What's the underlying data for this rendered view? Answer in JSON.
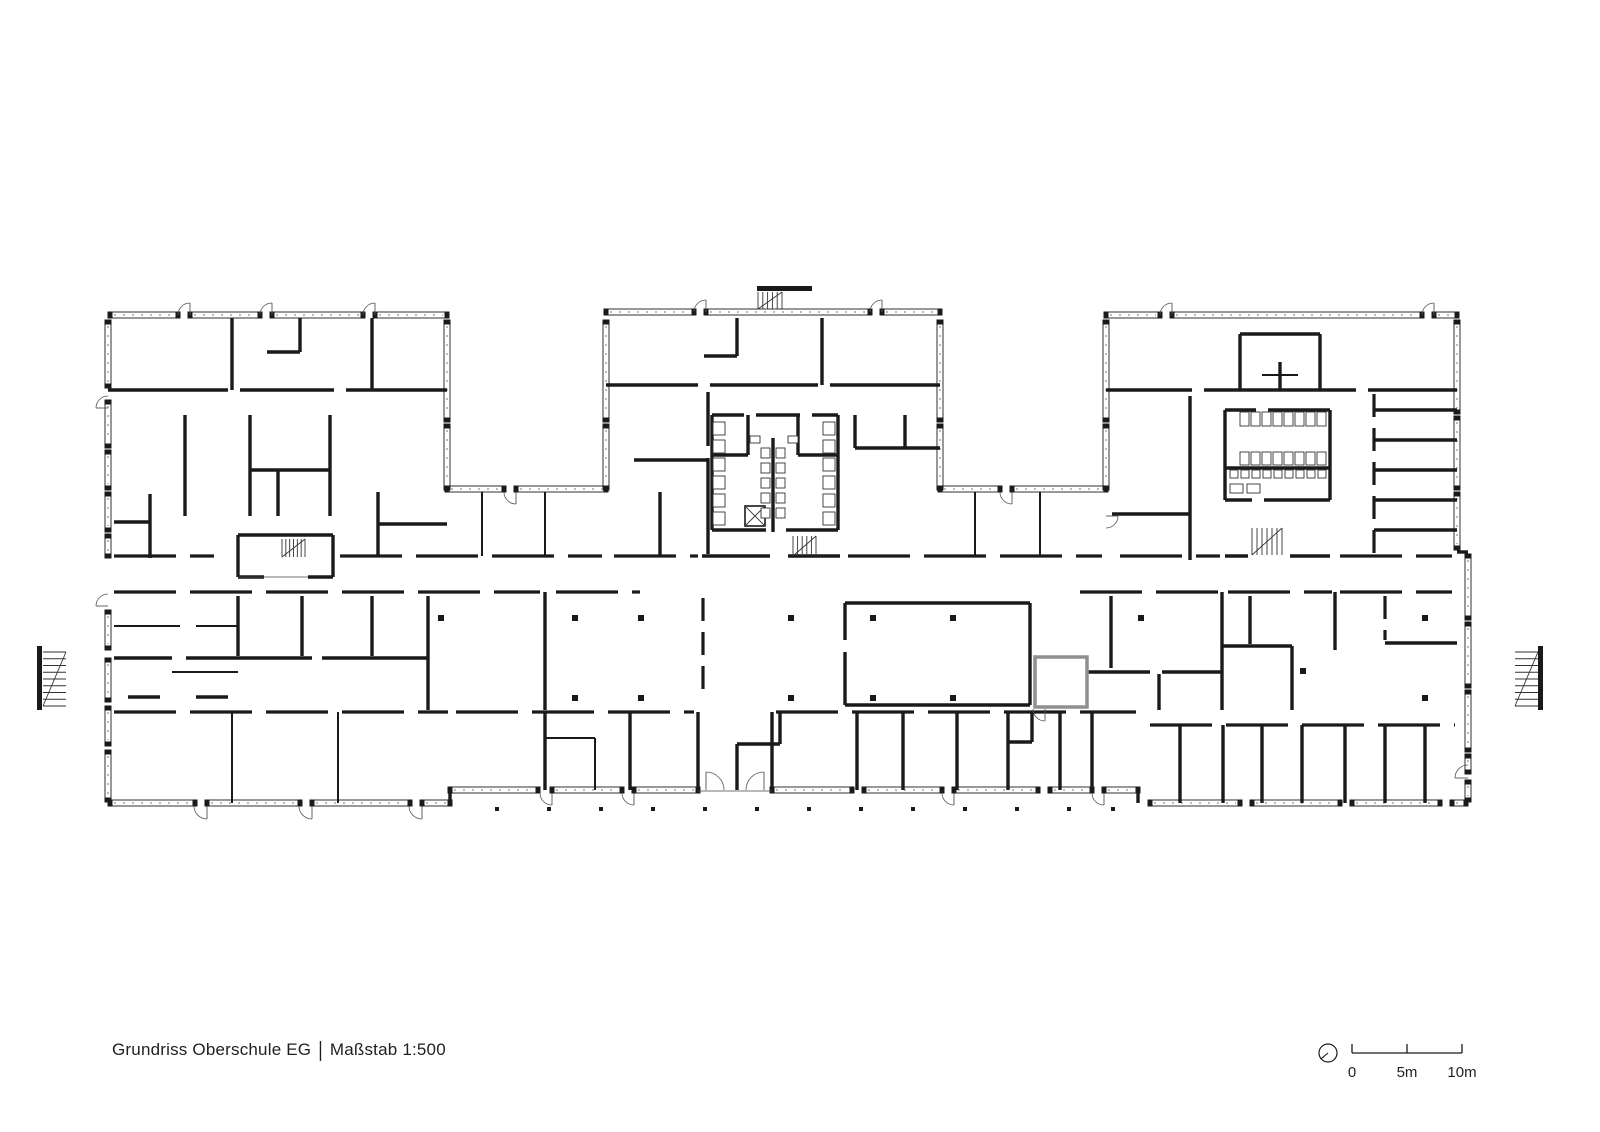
{
  "title_block": {
    "project": "Grundriss Oberschule EG",
    "separator": "|",
    "scale_text": "Maßstab 1:500"
  },
  "scale_bar": {
    "labels": [
      "0",
      "5m",
      "10m"
    ],
    "ticks_x": [
      1352,
      1407,
      1462
    ],
    "bar_y": 1053,
    "tick_h": 9,
    "north_circle": {
      "cx": 1328,
      "cy": 1053,
      "r": 9
    }
  },
  "drawing": {
    "ink": "#1a1a1a",
    "gray": "#8f8f8f",
    "canvas": {
      "w": 1600,
      "h": 1132
    },
    "walls_thick": [
      [
        108,
        390,
        228,
        390
      ],
      [
        240,
        390,
        334,
        390
      ],
      [
        346,
        390,
        447,
        390
      ],
      [
        232,
        318,
        232,
        390
      ],
      [
        372,
        318,
        372,
        390
      ],
      [
        300,
        318,
        300,
        352
      ],
      [
        267,
        352,
        300,
        352
      ],
      [
        185,
        415,
        185,
        516
      ],
      [
        250,
        415,
        250,
        516
      ],
      [
        330,
        415,
        330,
        516
      ],
      [
        278,
        470,
        278,
        516
      ],
      [
        250,
        470,
        330,
        470
      ],
      [
        150,
        494,
        150,
        558
      ],
      [
        114,
        522,
        150,
        522
      ],
      [
        238,
        535,
        333,
        535
      ],
      [
        238,
        535,
        238,
        577
      ],
      [
        333,
        535,
        333,
        577
      ],
      [
        238,
        577,
        264,
        577
      ],
      [
        308,
        577,
        333,
        577
      ],
      [
        378,
        492,
        378,
        556
      ],
      [
        378,
        524,
        447,
        524
      ],
      [
        606,
        385,
        698,
        385
      ],
      [
        710,
        385,
        818,
        385
      ],
      [
        830,
        385,
        940,
        385
      ],
      [
        737,
        318,
        737,
        356
      ],
      [
        704,
        356,
        737,
        356
      ],
      [
        822,
        318,
        822,
        385
      ],
      [
        708,
        392,
        708,
        446
      ],
      [
        708,
        458,
        708,
        554
      ],
      [
        634,
        460,
        708,
        460
      ],
      [
        660,
        492,
        660,
        556
      ],
      [
        712,
        415,
        744,
        415
      ],
      [
        756,
        415,
        800,
        415
      ],
      [
        812,
        415,
        838,
        415
      ],
      [
        712,
        415,
        712,
        530
      ],
      [
        838,
        415,
        838,
        530
      ],
      [
        773,
        438,
        773,
        532
      ],
      [
        712,
        455,
        748,
        455
      ],
      [
        798,
        455,
        838,
        455
      ],
      [
        748,
        415,
        748,
        455
      ],
      [
        798,
        415,
        798,
        455
      ],
      [
        712,
        530,
        766,
        530
      ],
      [
        786,
        530,
        838,
        530
      ],
      [
        702,
        556,
        770,
        556
      ],
      [
        788,
        556,
        840,
        556
      ],
      [
        855,
        415,
        855,
        448
      ],
      [
        855,
        448,
        940,
        448
      ],
      [
        905,
        415,
        905,
        448
      ],
      [
        1106,
        390,
        1192,
        390
      ],
      [
        1204,
        390,
        1356,
        390
      ],
      [
        1368,
        390,
        1457,
        390
      ],
      [
        1240,
        334,
        1240,
        390
      ],
      [
        1320,
        334,
        1320,
        390
      ],
      [
        1240,
        334,
        1320,
        334
      ],
      [
        1280,
        362,
        1280,
        390
      ],
      [
        1225,
        410,
        1256,
        410
      ],
      [
        1268,
        410,
        1330,
        410
      ],
      [
        1225,
        410,
        1225,
        500
      ],
      [
        1330,
        410,
        1330,
        500
      ],
      [
        1225,
        468,
        1330,
        468
      ],
      [
        1225,
        500,
        1252,
        500
      ],
      [
        1264,
        500,
        1330,
        500
      ],
      [
        1190,
        396,
        1190,
        514
      ],
      [
        1112,
        514,
        1190,
        514
      ],
      [
        1190,
        514,
        1190,
        560
      ],
      [
        1225,
        556,
        1248,
        556
      ],
      [
        1290,
        556,
        1330,
        556
      ],
      [
        1374,
        410,
        1457,
        410
      ],
      [
        1374,
        440,
        1457,
        440
      ],
      [
        1374,
        470,
        1457,
        470
      ],
      [
        1374,
        500,
        1457,
        500
      ],
      [
        1374,
        530,
        1457,
        530
      ],
      [
        450,
        790,
        450,
        806
      ],
      [
        1138,
        790,
        1138,
        803
      ],
      [
        238,
        596,
        238,
        656
      ],
      [
        302,
        596,
        302,
        656
      ],
      [
        372,
        596,
        372,
        656
      ],
      [
        428,
        596,
        428,
        710
      ],
      [
        545,
        592,
        545,
        710
      ],
      [
        114,
        658,
        172,
        658
      ],
      [
        186,
        658,
        312,
        658
      ],
      [
        322,
        658,
        428,
        658
      ],
      [
        128,
        697,
        160,
        697
      ],
      [
        196,
        697,
        228,
        697
      ],
      [
        845,
        603,
        1030,
        603
      ],
      [
        1030,
        603,
        1030,
        705
      ],
      [
        845,
        705,
        1030,
        705
      ],
      [
        845,
        603,
        845,
        640
      ],
      [
        845,
        652,
        845,
        705
      ],
      [
        1111,
        596,
        1111,
        668
      ],
      [
        1085,
        672,
        1150,
        672
      ],
      [
        1162,
        672,
        1222,
        672
      ],
      [
        1159,
        674,
        1159,
        710
      ],
      [
        1222,
        592,
        1222,
        710
      ],
      [
        1250,
        596,
        1250,
        644
      ],
      [
        1223,
        646,
        1292,
        646
      ],
      [
        1292,
        646,
        1292,
        710
      ],
      [
        1335,
        592,
        1335,
        650
      ],
      [
        1385,
        643,
        1457,
        643
      ],
      [
        545,
        712,
        545,
        790
      ],
      [
        630,
        712,
        630,
        790
      ],
      [
        698,
        712,
        698,
        790
      ],
      [
        772,
        712,
        772,
        790
      ],
      [
        780,
        712,
        780,
        744
      ],
      [
        737,
        744,
        780,
        744
      ],
      [
        737,
        744,
        737,
        790
      ],
      [
        857,
        712,
        857,
        790
      ],
      [
        903,
        712,
        903,
        790
      ],
      [
        957,
        712,
        957,
        790
      ],
      [
        1008,
        712,
        1008,
        790
      ],
      [
        1060,
        712,
        1060,
        790
      ],
      [
        1092,
        712,
        1092,
        790
      ],
      [
        1032,
        712,
        1032,
        742
      ],
      [
        1008,
        742,
        1032,
        742
      ],
      [
        1180,
        725,
        1180,
        803
      ],
      [
        1223,
        725,
        1223,
        803
      ],
      [
        1262,
        725,
        1262,
        803
      ],
      [
        1302,
        725,
        1302,
        803
      ],
      [
        1345,
        725,
        1345,
        803
      ],
      [
        1385,
        725,
        1385,
        803
      ],
      [
        1425,
        725,
        1425,
        803
      ],
      [
        1457,
        552,
        1468,
        552
      ]
    ],
    "walls_medium": [
      [
        482,
        492,
        482,
        556
      ],
      [
        545,
        492,
        545,
        556
      ],
      [
        975,
        492,
        975,
        556
      ],
      [
        1040,
        492,
        1040,
        556
      ],
      [
        172,
        672,
        238,
        672
      ],
      [
        232,
        712,
        232,
        803
      ],
      [
        338,
        712,
        338,
        803
      ],
      [
        545,
        738,
        595,
        738
      ],
      [
        595,
        738,
        595,
        790
      ],
      [
        1262,
        375,
        1298,
        375
      ],
      [
        114,
        626,
        180,
        626
      ],
      [
        196,
        626,
        238,
        626
      ]
    ],
    "dashed_h": [
      {
        "y": 556,
        "x0": 114,
        "x1": 214
      },
      {
        "y": 556,
        "x0": 340,
        "x1": 602
      },
      {
        "y": 556,
        "x0": 614,
        "x1": 698
      },
      {
        "y": 556,
        "x0": 848,
        "x1": 1102
      },
      {
        "y": 556,
        "x0": 1120,
        "x1": 1220
      },
      {
        "y": 556,
        "x0": 1340,
        "x1": 1452
      },
      {
        "y": 592,
        "x0": 114,
        "x1": 540
      },
      {
        "y": 592,
        "x0": 556,
        "x1": 640
      },
      {
        "y": 592,
        "x0": 1080,
        "x1": 1218
      },
      {
        "y": 592,
        "x0": 1228,
        "x1": 1332
      },
      {
        "y": 592,
        "x0": 1340,
        "x1": 1452
      },
      {
        "y": 712,
        "x0": 114,
        "x1": 448
      },
      {
        "y": 712,
        "x0": 456,
        "x1": 694
      },
      {
        "y": 712,
        "x0": 776,
        "x1": 1136
      },
      {
        "y": 725,
        "x0": 1150,
        "x1": 1455
      }
    ],
    "dashed_v": [
      {
        "x": 703,
        "y0": 598,
        "y1": 690
      },
      {
        "x": 1374,
        "y0": 394,
        "y1": 554
      },
      {
        "x": 1385,
        "y0": 596,
        "y1": 640
      }
    ],
    "window_bands_h": [
      [
        110,
        315,
        68
      ],
      [
        190,
        315,
        70
      ],
      [
        272,
        315,
        91
      ],
      [
        375,
        315,
        72
      ],
      [
        606,
        312,
        88
      ],
      [
        706,
        312,
        164
      ],
      [
        882,
        312,
        58
      ],
      [
        1106,
        315,
        54
      ],
      [
        1172,
        315,
        250
      ],
      [
        1434,
        315,
        23
      ],
      [
        447,
        489,
        57
      ],
      [
        516,
        489,
        90
      ],
      [
        940,
        489,
        60
      ],
      [
        1012,
        489,
        94
      ],
      [
        110,
        803,
        85
      ],
      [
        207,
        803,
        93
      ],
      [
        312,
        803,
        98
      ],
      [
        422,
        803,
        28
      ],
      [
        450,
        790,
        88
      ],
      [
        552,
        790,
        70
      ],
      [
        634,
        790,
        64
      ],
      [
        772,
        790,
        80
      ],
      [
        864,
        790,
        78
      ],
      [
        954,
        790,
        84
      ],
      [
        1050,
        790,
        42
      ],
      [
        1104,
        790,
        34
      ],
      [
        1150,
        803,
        90
      ],
      [
        1252,
        803,
        88
      ],
      [
        1352,
        803,
        88
      ],
      [
        1452,
        803,
        14
      ]
    ],
    "window_bands_v": [
      [
        108,
        322,
        64
      ],
      [
        108,
        402,
        44
      ],
      [
        108,
        452,
        36
      ],
      [
        108,
        494,
        36
      ],
      [
        108,
        536,
        20
      ],
      [
        108,
        612,
        36
      ],
      [
        108,
        660,
        40
      ],
      [
        108,
        708,
        36
      ],
      [
        108,
        752,
        48
      ],
      [
        447,
        322,
        98
      ],
      [
        447,
        426,
        62
      ],
      [
        606,
        322,
        98
      ],
      [
        606,
        426,
        62
      ],
      [
        940,
        322,
        98
      ],
      [
        940,
        426,
        62
      ],
      [
        1106,
        322,
        98
      ],
      [
        1106,
        426,
        62
      ],
      [
        1457,
        322,
        90
      ],
      [
        1457,
        418,
        70
      ],
      [
        1457,
        494,
        54
      ],
      [
        1468,
        556,
        62
      ],
      [
        1468,
        624,
        62
      ],
      [
        1468,
        692,
        58
      ],
      [
        1468,
        756,
        16
      ],
      [
        1468,
        782,
        18
      ]
    ],
    "doors": [
      [
        190,
        315,
        12,
        180,
        90
      ],
      [
        272,
        315,
        12,
        180,
        90
      ],
      [
        375,
        315,
        12,
        180,
        90
      ],
      [
        706,
        312,
        12,
        180,
        90
      ],
      [
        882,
        312,
        12,
        180,
        90
      ],
      [
        1172,
        315,
        12,
        180,
        90
      ],
      [
        1434,
        315,
        12,
        180,
        90
      ],
      [
        516,
        492,
        12,
        180,
        270
      ],
      [
        1012,
        492,
        12,
        180,
        270
      ],
      [
        108,
        408,
        12,
        90,
        180
      ],
      [
        108,
        606,
        12,
        90,
        180
      ],
      [
        207,
        806,
        13,
        180,
        270
      ],
      [
        312,
        806,
        13,
        180,
        270
      ],
      [
        422,
        806,
        13,
        180,
        270
      ],
      [
        552,
        793,
        12,
        180,
        270
      ],
      [
        634,
        793,
        12,
        180,
        270
      ],
      [
        954,
        793,
        12,
        180,
        270
      ],
      [
        1104,
        793,
        12,
        180,
        270
      ],
      [
        706,
        790,
        18,
        0,
        90
      ],
      [
        764,
        790,
        18,
        180,
        90
      ],
      [
        1468,
        778,
        13,
        90,
        180
      ],
      [
        1106,
        516,
        12,
        270,
        360
      ],
      [
        1045,
        709,
        12,
        180,
        270
      ]
    ],
    "columns": [
      [
        441,
        618
      ],
      [
        575,
        618
      ],
      [
        641,
        618
      ],
      [
        791,
        618
      ],
      [
        873,
        618
      ],
      [
        953,
        618
      ],
      [
        1141,
        618
      ],
      [
        1425,
        618
      ],
      [
        575,
        698
      ],
      [
        641,
        698
      ],
      [
        791,
        698
      ],
      [
        873,
        698
      ],
      [
        953,
        698
      ],
      [
        1425,
        698
      ],
      [
        1303,
        671
      ]
    ],
    "outer_dots": {
      "y": 809,
      "xs": [
        497,
        549,
        601,
        653,
        705,
        757,
        809,
        861,
        913,
        965,
        1017,
        1069,
        1113
      ]
    },
    "stairs": [
      {
        "x": 282,
        "y": 539,
        "w": 23,
        "h": 18,
        "dir": "v",
        "n": 7
      },
      {
        "x": 758,
        "y": 292,
        "w": 24,
        "h": 17,
        "dir": "v",
        "n": 6
      },
      {
        "x": 793,
        "y": 536,
        "w": 23,
        "h": 20,
        "dir": "v",
        "n": 6
      },
      {
        "x": 1252,
        "y": 528,
        "w": 30,
        "h": 27,
        "dir": "v",
        "n": 7
      },
      {
        "x": 43,
        "y": 652,
        "w": 23,
        "h": 54,
        "dir": "h",
        "n": 9
      },
      {
        "x": 1515,
        "y": 652,
        "w": 23,
        "h": 54,
        "dir": "h",
        "n": 9
      }
    ],
    "stair_bars": [
      [
        757,
        286,
        55,
        5
      ],
      [
        37,
        646,
        5,
        64
      ],
      [
        1538,
        646,
        5,
        64
      ]
    ],
    "elevators": [
      [
        745,
        506,
        20,
        20
      ]
    ],
    "fixture_grids": [
      {
        "x": 713,
        "y": 422,
        "w": 12,
        "h": 13,
        "dx": 0,
        "dy": 18,
        "n": 6
      },
      {
        "x": 823,
        "y": 422,
        "w": 12,
        "h": 13,
        "dx": 0,
        "dy": 18,
        "n": 6
      },
      {
        "x": 761,
        "y": 448,
        "w": 9,
        "h": 10,
        "dx": 0,
        "dy": 15,
        "n": 5
      },
      {
        "x": 776,
        "y": 448,
        "w": 9,
        "h": 10,
        "dx": 0,
        "dy": 15,
        "n": 5
      },
      {
        "x": 750,
        "y": 436,
        "w": 10,
        "h": 7,
        "dx": 38,
        "dy": 0,
        "n": 2
      },
      {
        "x": 1240,
        "y": 412,
        "w": 9,
        "h": 14,
        "dx": 11,
        "dy": 0,
        "n": 8
      },
      {
        "x": 1240,
        "y": 452,
        "w": 9,
        "h": 13,
        "dx": 11,
        "dy": 0,
        "n": 8
      },
      {
        "x": 1230,
        "y": 470,
        "w": 8,
        "h": 8,
        "dx": 11,
        "dy": 0,
        "n": 9
      },
      {
        "x": 1230,
        "y": 484,
        "w": 13,
        "h": 9,
        "dx": 17,
        "dy": 0,
        "n": 2
      }
    ],
    "gray_rooms": [
      [
        1035,
        657,
        52,
        50
      ]
    ],
    "thin_lines": [
      [
        238,
        577,
        308,
        577
      ],
      [
        698,
        791,
        772,
        791
      ]
    ]
  }
}
